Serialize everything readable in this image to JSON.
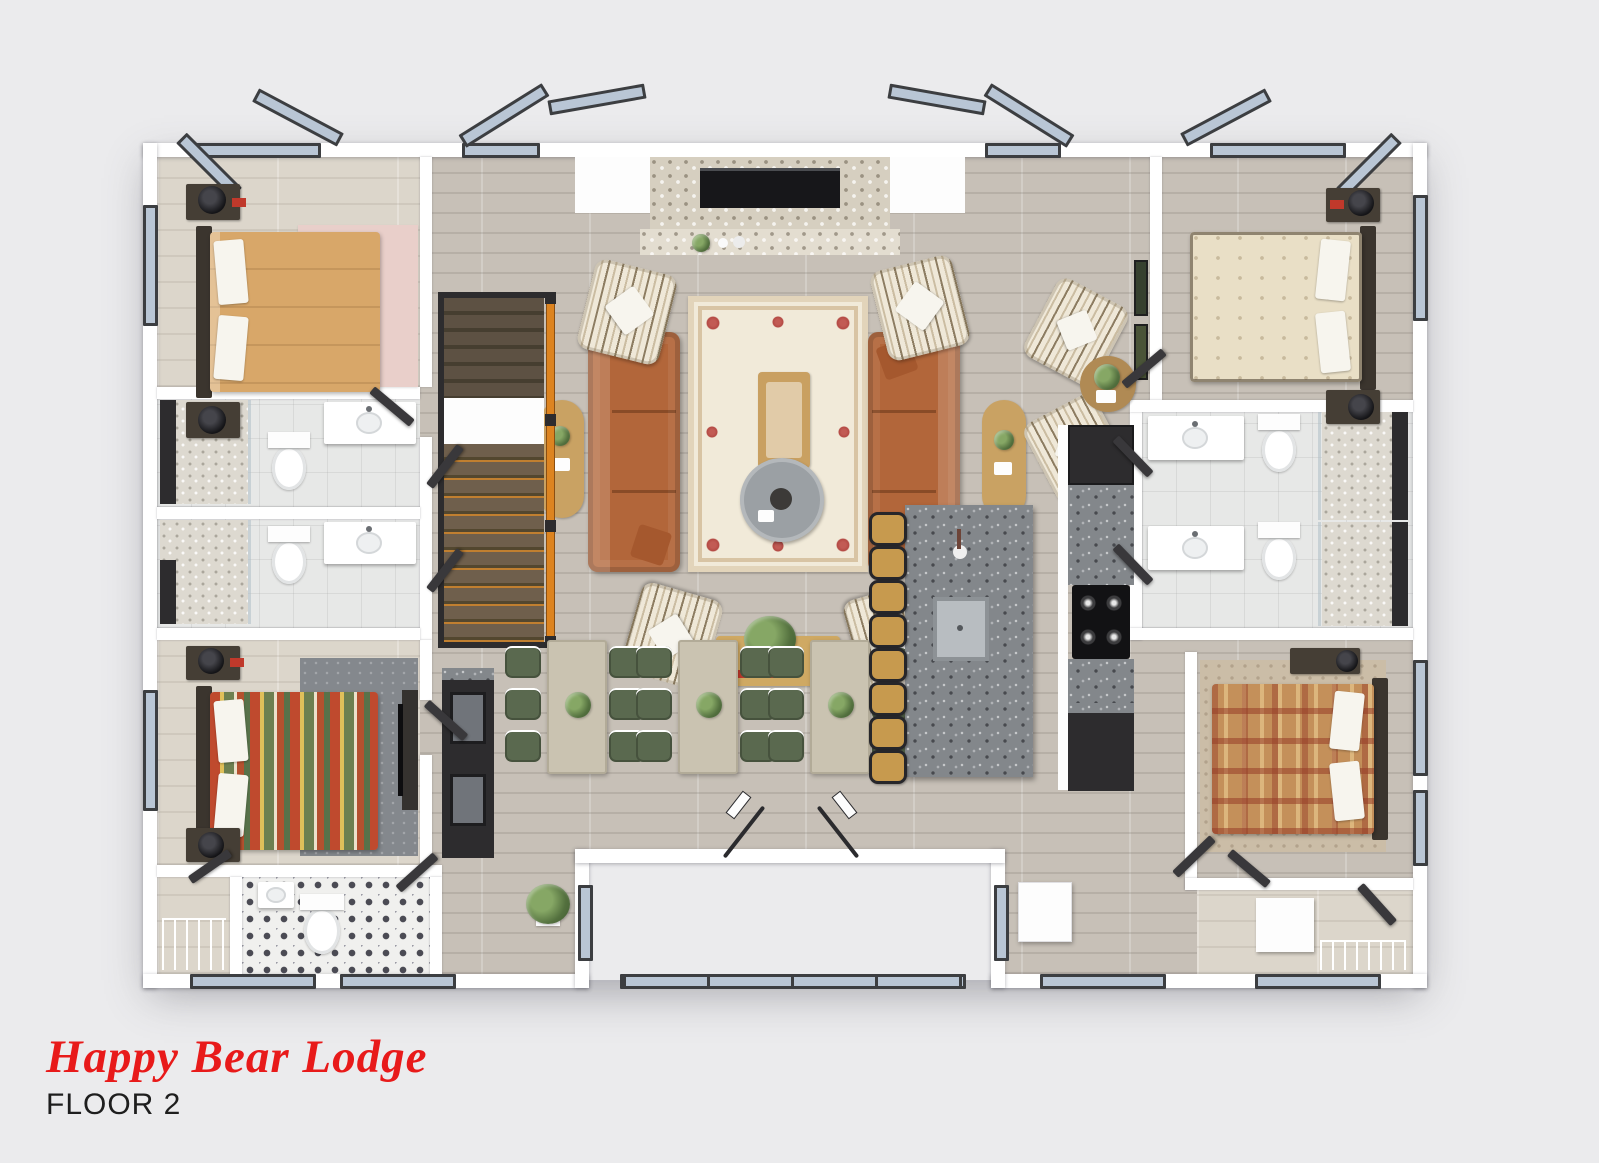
{
  "header": {
    "title": "Happy Bear Lodge",
    "floor_label": "FLOOR 2"
  },
  "palette": {
    "page_background": "#ebebed",
    "title_red": "#e81a1a",
    "floor_label_black": "#1e1e1e",
    "wall_white": "#ffffff",
    "wood_floor_gray": "#c7c0b7",
    "wood_floor_light": "#dcd6cb",
    "window_glass_blue": "#b9c6d5",
    "window_frame_dark": "#3c3e41",
    "sofa_cognac": "#b2663a",
    "bed_tan": "#d8a769",
    "bed_stripe_red": "#bf4a2e",
    "bed_cream": "#e9dfc6",
    "bed_plaid_rust": "#c4905a",
    "dining_chair_green": "#5a694f",
    "stool_tan": "#c79a4e",
    "stair_rail_orange": "#dd8420",
    "granite_gray": "#83878b",
    "rug_cream": "#f1ead9"
  },
  "plan": {
    "view": "3D top-down floor plan rendering",
    "rooms": [
      "bedroom-top-left",
      "bathroom-left-upper",
      "bathroom-left-lower",
      "bedroom-bottom-left",
      "powder-room",
      "great-room",
      "dining-area",
      "kitchen",
      "bedroom-top-right",
      "bathroom-right-upper",
      "bathroom-right-lower",
      "bedroom-bottom-right",
      "stair-hall",
      "deck-recess"
    ],
    "furniture_counts": {
      "beds": 4,
      "sofas": 2,
      "striped_armchairs": 6,
      "dining_tables": 3,
      "dining_chairs": 18,
      "bar_stools": 8,
      "toilets": 5,
      "showers": 4,
      "vanities": 5,
      "fireplaces": 1,
      "staircases": 1,
      "telescopes": 2
    }
  }
}
